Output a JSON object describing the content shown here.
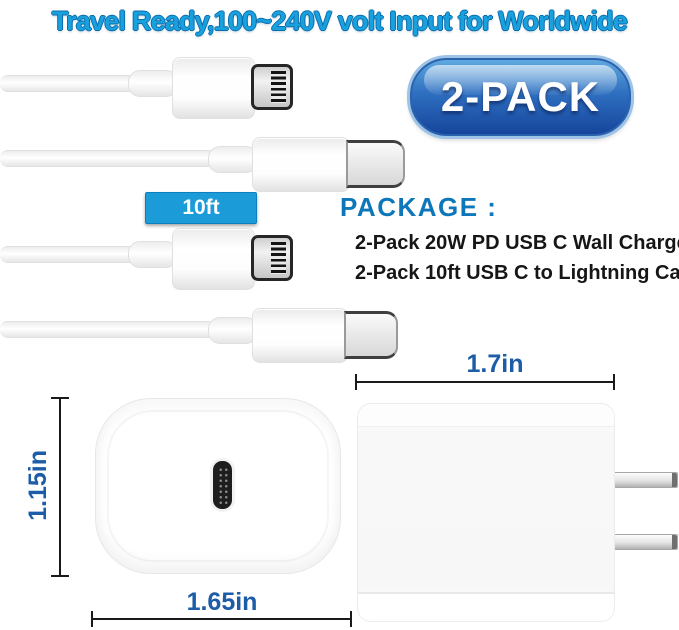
{
  "headline": "Travel Ready,100~240V volt Input for Worldwide",
  "badge": {
    "label": "2-PACK"
  },
  "cable_tag": {
    "label": "10ft"
  },
  "package": {
    "heading": "PACKAGE :",
    "items": [
      "2-Pack 20W PD USB C Wall Charger",
      "2-Pack 10ft USB C to Lightning Cables"
    ]
  },
  "dimensions": {
    "side_width": "1.7in",
    "front_height": "1.15in",
    "front_width": "1.65in"
  },
  "images": {
    "lightning_connector": "lightning-connector",
    "usbc_connector": "usbc-connector",
    "wall_charger_front": "wall-charger-front-view",
    "wall_charger_side": "wall-charger-side-view"
  },
  "colors": {
    "headline_blue": "#18A1DC",
    "headline_outline": "#0B6CAE",
    "badge_blue_light": "#5FA8DF",
    "badge_blue_dark": "#16459C",
    "tag_blue": "#1B9CD8",
    "package_heading_blue": "#0E77BA",
    "dimension_blue": "#1D5CA7",
    "body_text": "#161616",
    "background": "#FFFFFF"
  }
}
